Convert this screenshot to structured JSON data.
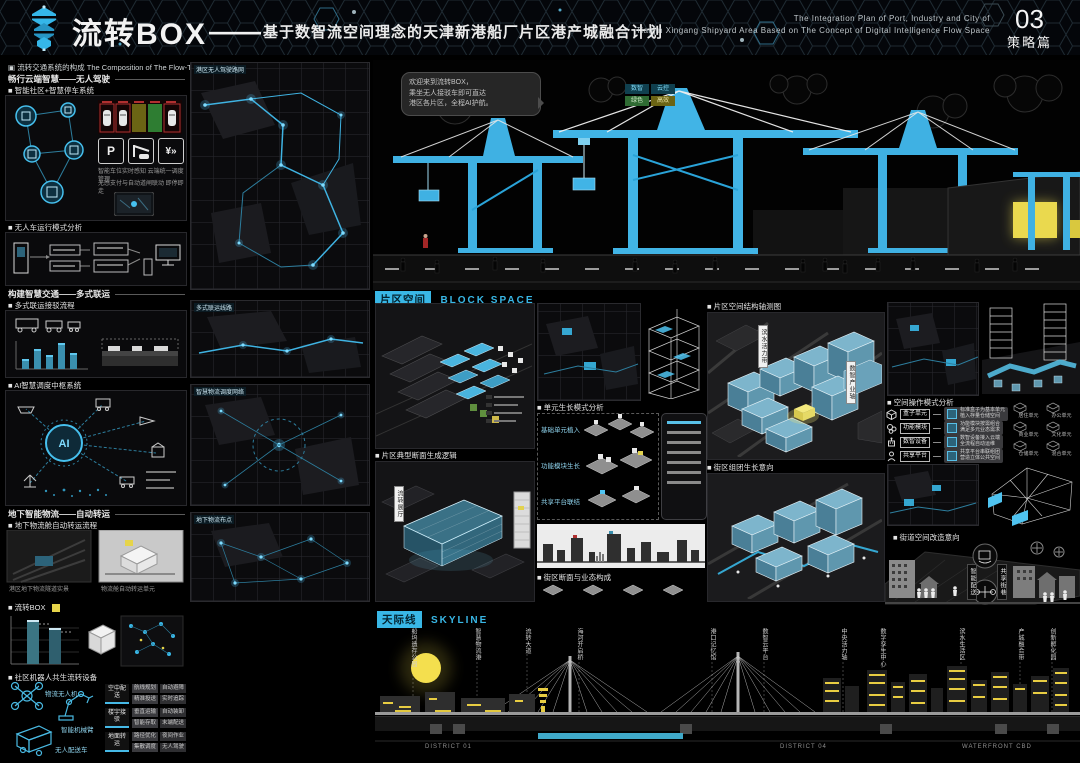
{
  "header": {
    "title": "流转BOX",
    "dash": "——",
    "subtitle": "基于数智流空间理念的天津新港船厂片区港产城融合计划",
    "en1": "The Integration Plan of Port, Industry and City of",
    "en2": "Tianjin Xingang Shipyard Area Based on The Concept of Digital Intelligence Flow Space",
    "page_num": "03",
    "page_name": "策略篇"
  },
  "left": {
    "section_bullet": "▣",
    "section_title": "流转交通系统的构成 The Composition of The Flow-Transfer Transport System",
    "h1": "畅行云端智慧——无人驾驶",
    "p1_caption": "■ 智能社区+智慧停车系统",
    "p1_note1": "智能车位实时感知 云端统一调度管理",
    "p1_note2": "无感支付与自动道闸联动 即停即走",
    "icon_p": "P",
    "icon_pay": "¥»",
    "p2_caption": "■ 无人车运行模式分析",
    "h2": "构建智慧交通——多式联运",
    "p3_caption": "■ 多式联运接驳流程",
    "ai_caption": "■ AI智慧调度中枢系统",
    "ai_label": "AI",
    "h4": "地下智能物流——自动转运",
    "p4_caption": "■ 地下物流舱自动转运流程",
    "p4_note1": "港区地下物流隧道实景",
    "p4_note2": "物流舱自动转运单元",
    "box_caption": "■ 流转BOX",
    "box_note1": "流转BOX装卸作业分析",
    "box_note2": "流转BOX社区布点示意",
    "robot_caption": "■ 社区机器人共生流转设备",
    "robot_item1": "物流无人机",
    "robot_item2": "智能机械臂",
    "robot_item3": "无人配送车",
    "table": {
      "r1g": "空中配送",
      "r1c1": "航线规划",
      "r1c2": "自动避障",
      "r1c3": "精准投送",
      "r1c4": "实时追踪",
      "r2g": "楼宇接驳",
      "r2c1": "垂直运输",
      "r2c2": "自动装卸",
      "r2c3": "智能存取",
      "r2c4": "末端配送",
      "r3g": "地面转运",
      "r3c1": "路径优化",
      "r3c2": "夜间作业",
      "r3c3": "集散调度",
      "r3c4": "无人驾驶"
    }
  },
  "maps": {
    "m1": "港区无人驾驶路网",
    "m2": "多式联运线路",
    "m3": "智慧物流调度网络",
    "m4": "地下物流布点"
  },
  "render": {
    "bubble1": "欢迎来到流转BOX，",
    "bubble2": "乘坐无人接驳车即可直达",
    "bubble3": "港区各片区，全程AI护航。",
    "chip1": "数智",
    "chip2": "云控",
    "chip3": "绿色",
    "chip4": "高效"
  },
  "block": {
    "tag": "片区空间",
    "tag_en": "BLOCK SPACE",
    "a_cap2": "■ 片区典型断面生成逻辑",
    "a2_tag": "流转展厅",
    "b_cap": "■ 单元生长模式分析",
    "b_r1": "基础单元植入",
    "b_r2": "功能模块生长",
    "b_r3": "共享平台联结",
    "b_cap2": "■ 街区断面与业态构成",
    "c_cap1": "■ 片区空间结构轴测图",
    "c_tag1": "滨水活力带",
    "c_tag2": "数智产业轴",
    "c_cap2": "■ 街区组团生长意向",
    "d_cap1": "■ 空间操作模式分析",
    "op1": "盒子单元",
    "op1d1": "标准盒子为基本单元",
    "op1d2": "植入存量仓储空间",
    "op2": "功能模块",
    "op2d1": "功能模块按需组合",
    "op2d2": "满足多元业态需求",
    "op3": "数智设备",
    "op3d1": "数智设备接入云端",
    "op3d2": "全流程自动运维",
    "op4": "共享平台",
    "op4d1": "共享平台串联组团",
    "op4d2": "营造立体公共空间",
    "g1": "居住单元",
    "g2": "办公单元",
    "g3": "商业单元",
    "g4": "文化单元",
    "g5": "仓储单元",
    "g6": "混合单元",
    "d_cap2": "■ 街道空间改造意向",
    "d_tag1": "智能配送",
    "d_tag2": "共享街巷"
  },
  "skyline": {
    "tag": "天际线",
    "tag_en": "SKYLINE",
    "l1": "船坞遗存公园",
    "l2": "智慧物流港",
    "l3": "流转大道",
    "l4": "海河开启桥",
    "l5": "港口记忆馆",
    "l6": "数智云平台",
    "l7": "中央活力轴",
    "l8": "数字孪生中心",
    "l9": "滨水生活区",
    "l10": "产城融合带",
    "l11": "创新孵化园",
    "b1": "DISTRICT 01",
    "b2": "DISTRICT 04",
    "b3": "WATERFRONT CBD"
  },
  "colors": {
    "accent_cyan": "#39b7e6",
    "crane_cyan": "#41b4e6",
    "glow_yellow": "#ead94e",
    "steel_blue": "#5f97ae",
    "moon_yellow": "#f4df4e"
  }
}
